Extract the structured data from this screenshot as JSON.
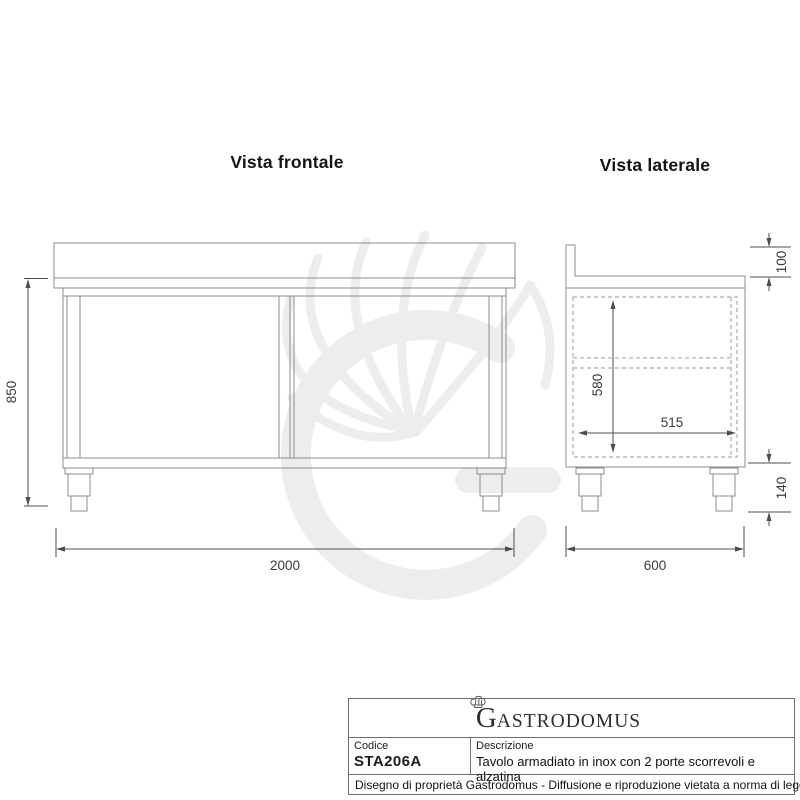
{
  "titles": {
    "front": "Vista frontale",
    "side": "Vista laterale"
  },
  "front_view": {
    "height_mm": "850",
    "width_mm": "2000"
  },
  "side_view": {
    "backsplash_mm": "100",
    "inner_height_mm": "580",
    "inner_depth_mm": "515",
    "leg_mm": "140",
    "depth_mm": "600"
  },
  "title_block": {
    "logo_g": "G",
    "logo_rest": "ASTRODOMUS",
    "code_label": "Codice",
    "code_value": "STA206A",
    "description_label": "Descrizione",
    "description_value": "Tavolo armadiato in inox con 2 porte scorrevoli e alzatina",
    "footer": "Disegno di proprietà Gastrodomus - Diffusione e riproduzione vietata a norma di legge."
  },
  "colors": {
    "drawing_line": "#8c8c8c",
    "dashed_line": "#9a9a9a",
    "dimension": "#4d4d4d",
    "watermark": "#ededed",
    "block_border": "#6e6e6e",
    "title_text": "#141414"
  },
  "icons": {
    "watermark": "chef-hat-logo-watermark",
    "logo_mark": "chef-hat-icon"
  }
}
